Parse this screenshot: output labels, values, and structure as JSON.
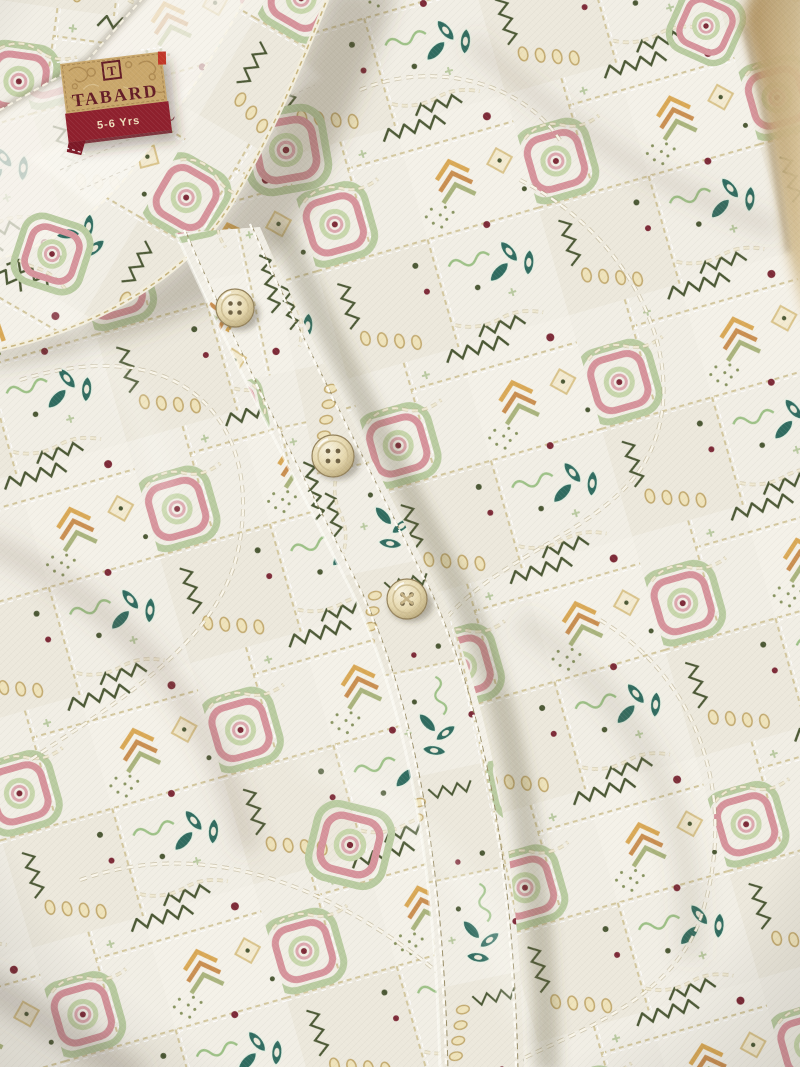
{
  "meta": {
    "alt": "Flat-lay close-up photo of a cream kids kurta shirt with multicolour ethnic block print, mandarin band collar, diagonal buttoned front placket with pearl buttons, and a woven TABARD brand size label at the inside back neck"
  },
  "brand_label": {
    "brand": "TABARD",
    "monogram": "T",
    "size": "5-6 Yrs",
    "tag_gold": "#c9a76b",
    "band_maroon": "#8f202d",
    "text_maroon": "#631c25",
    "size_text_color": "#efdfbd",
    "red_tab": "#c13527"
  },
  "garment": {
    "type": "kurta shirt",
    "collar": "mandarin band collar",
    "closure": "front button placket",
    "button_count": 3,
    "button_color": "#e6d8ae"
  },
  "print_palette": {
    "base_cream": "#f0ede4",
    "sage_green": "#b9cba0",
    "dark_olive": "#4a5733",
    "teal_green": "#2f6b5f",
    "rose_pink": "#d6939b",
    "maroon_dot": "#7c2936",
    "gold_ochre": "#d2a55c",
    "metallic_thread": "#ede5ca"
  }
}
